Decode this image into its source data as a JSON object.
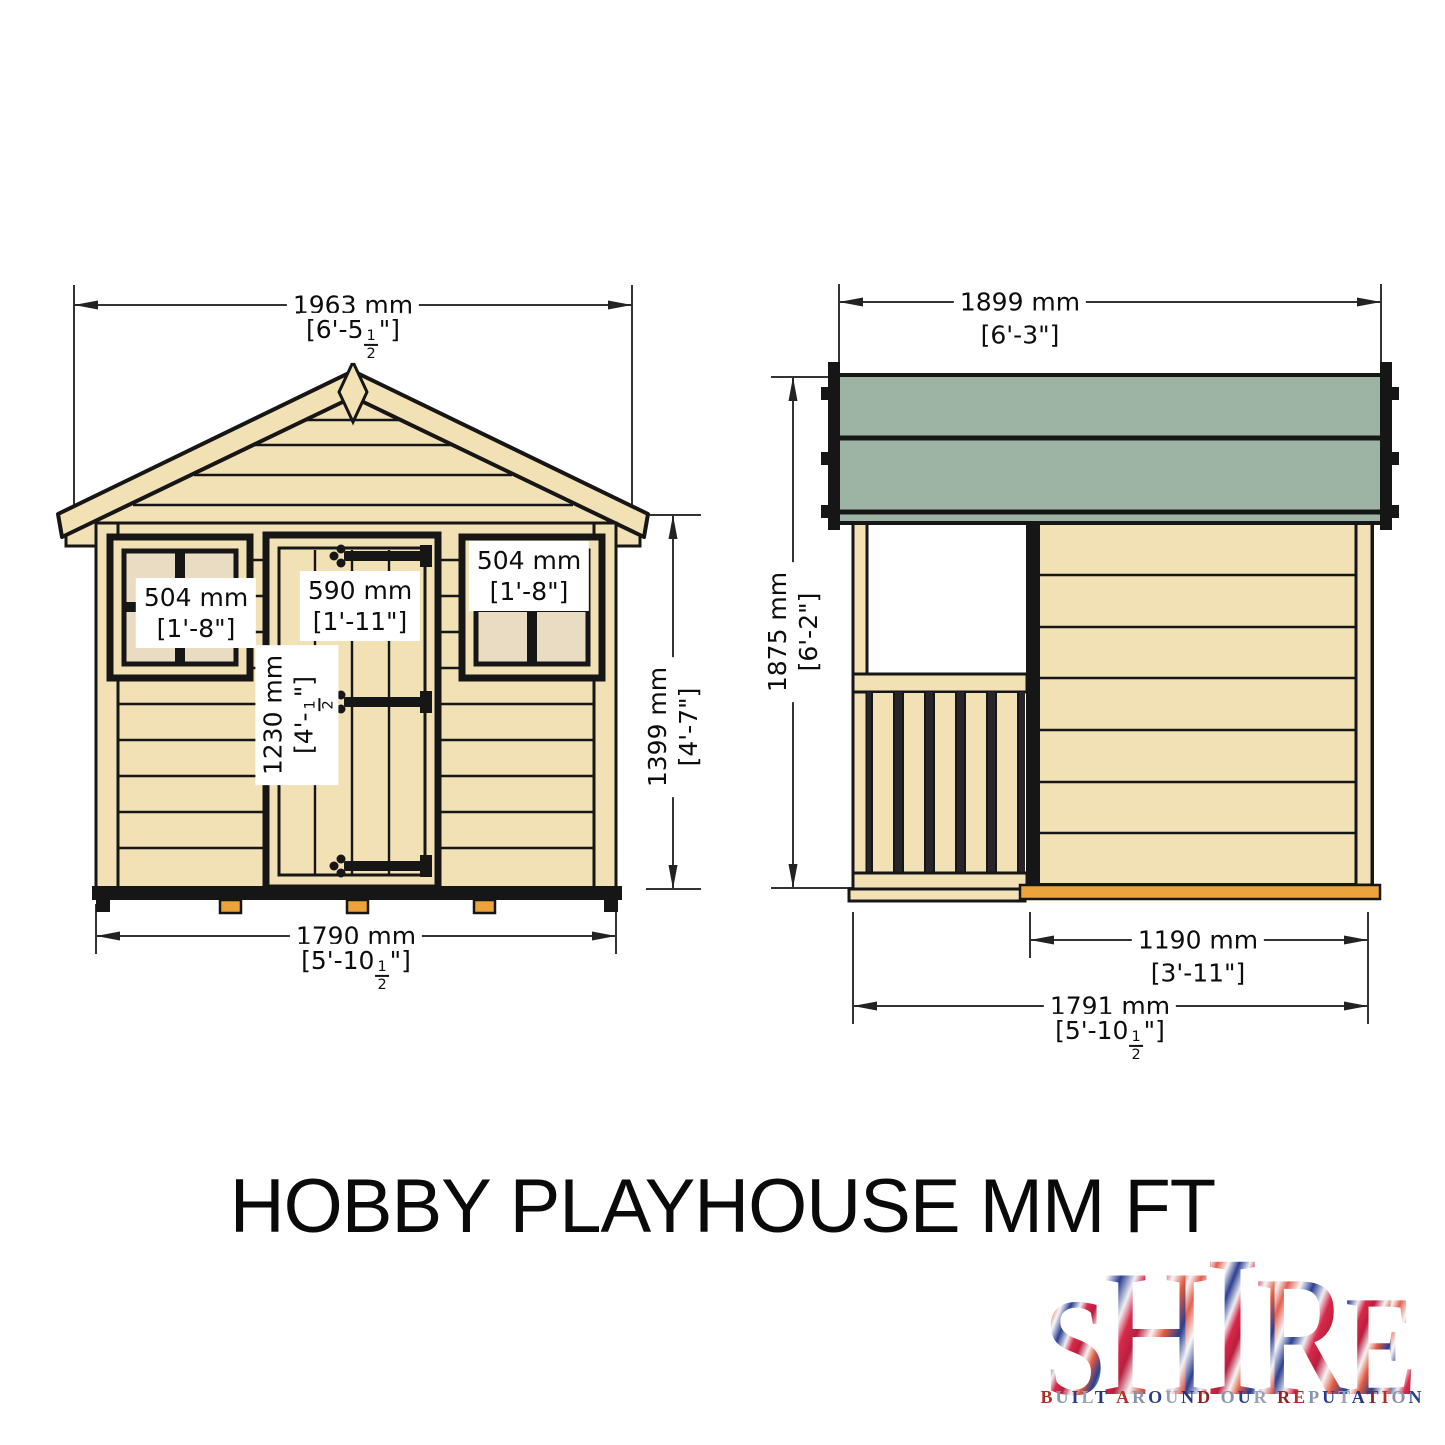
{
  "title": "HOBBY PLAYHOUSE MM FT",
  "front_view": {
    "dim_roof_width": {
      "mm": "1963 mm",
      "ft_pre": "[6'-5",
      "frac_num": "1",
      "frac_den": "2",
      "ft_post": "\"]"
    },
    "dim_window_left": {
      "line1": "504 mm",
      "line2": "[1'-8\"]"
    },
    "dim_door_width": {
      "line1": "590 mm",
      "line2": "[1'-11\"]"
    },
    "dim_window_right": {
      "line1": "504 mm",
      "line2": "[1'-8\"]"
    },
    "dim_door_height": {
      "mm": "1230 mm",
      "ft_pre": "[4'-",
      "frac_num": "1",
      "frac_den": "2",
      "ft_post": "\"]"
    },
    "dim_wall_height": {
      "mm": "1399 mm",
      "ft": "[4'-7\"]"
    },
    "dim_base_width": {
      "mm": "1790 mm",
      "ft_pre": "[5'-10",
      "frac_num": "1",
      "frac_den": "2",
      "ft_post": "\"]"
    }
  },
  "side_view": {
    "dim_roof_length": {
      "mm": "1899 mm",
      "ft": "[6'-3\"]"
    },
    "dim_height": {
      "mm": "1875 mm",
      "ft": "[6'-2\"]"
    },
    "dim_cabin_length": {
      "mm": "1190 mm",
      "ft": "[3'-11\"]"
    },
    "dim_total_length": {
      "mm": "1791 mm",
      "ft_pre": "[5'-10",
      "frac_num": "1",
      "frac_den": "2",
      "ft_post": "\"]"
    }
  },
  "logo": {
    "word": "SHIRE",
    "tagline": "BUILT AROUND OUR REPUTATION"
  },
  "colors": {
    "wood": "#f2e1b4",
    "pane": "#e9dcc3",
    "roof": "#9db4a4",
    "skid": "#eca33c",
    "line": "#161616"
  }
}
